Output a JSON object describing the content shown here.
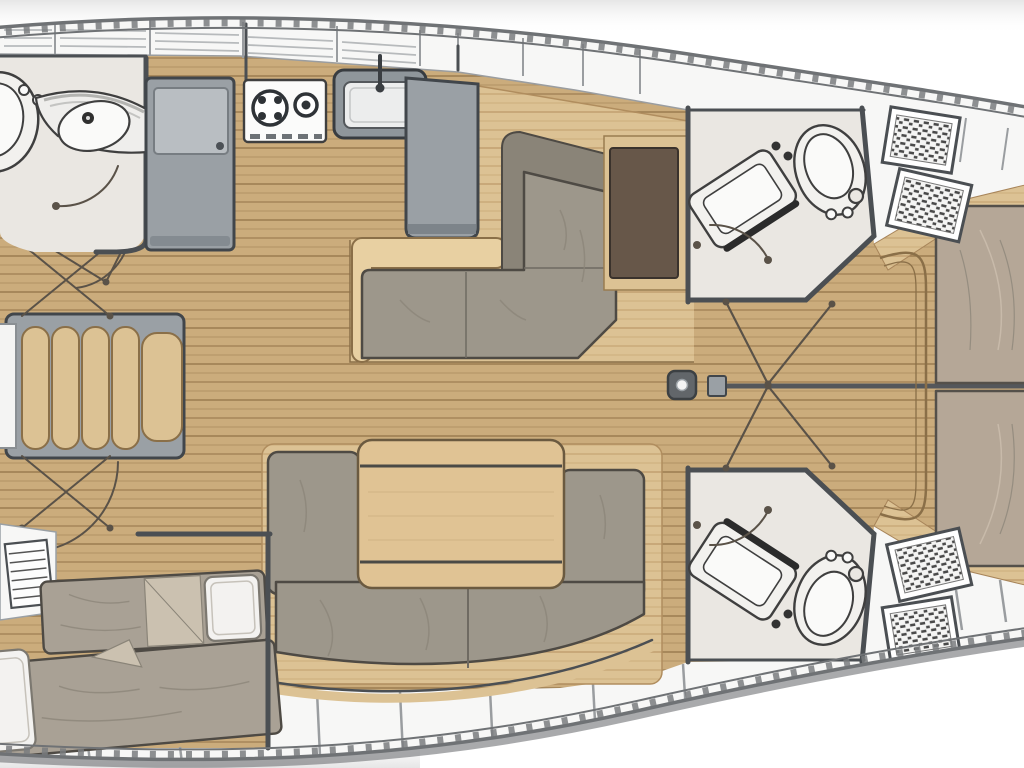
{
  "diagram": {
    "type": "sailing-yacht-interior-floor-plan",
    "view": "top-down",
    "bow_direction": "right",
    "palette": {
      "outside_bg": "#ffffff",
      "corner_shade": "#e6e6e6",
      "hull_line": "#6f7275",
      "rub_rail": "#7a7d7f",
      "deck_white": "#f7f7f6",
      "deck_line": "#9a9da0",
      "louver_line": "#b7babc",
      "floor_wood": "#cbac7c",
      "floor_plank_line": "#9b7c50",
      "platform_wood": "#dcc294",
      "platform_plank_line": "#bb9766",
      "step_wood": "#e8d0a2",
      "step_edge": "#8a6f48",
      "cushion_taupe": "#9d978b",
      "cushion_outline": "#4e4a44",
      "backrest_taupe": "#8a8478",
      "mattress_taupe": "#a9a195",
      "bed_taupe": "#b5a797",
      "pillow_white": "#f3f2f0",
      "table_wood": "#e0c394",
      "table_edge": "#6b5a40",
      "chart_table_brown": "#675749",
      "cabinet_gray": "#9aa0a5",
      "cabinet_outline": "#41464b",
      "cabinet_panel": "#b9bec2",
      "bathroom_floor": "#eae7e2",
      "fixture_white": "#f2f1ee",
      "fixture_outline": "#3f3f3f",
      "wall_dark": "#4b4f53",
      "door_line": "#5a5248",
      "hatch_dark": "#4a4a4a",
      "mast_gray": "#62666a"
    },
    "rooms": [
      {
        "name": "port-head",
        "fixtures": [
          "toilet",
          "curved-vanity-sink",
          "door-swing"
        ]
      },
      {
        "name": "galley",
        "fixtures": [
          "refrigerator",
          "two-burner-stove",
          "sink-with-faucet",
          "island-counter"
        ]
      },
      {
        "name": "dinette",
        "fixtures": [
          "l-shaped-settee",
          "chart-table",
          "raised-platform",
          "step"
        ]
      },
      {
        "name": "salon",
        "fixtures": [
          "u-shaped-sofa",
          "folding-table"
        ]
      },
      {
        "name": "port-aft-cabin",
        "fixtures": [
          "single-berth-with-pillow",
          "single-berth-with-pillow",
          "louvered-step"
        ]
      },
      {
        "name": "lounge-settee",
        "fixtures": [
          "ribbed-chaise",
          "side-shelf"
        ]
      },
      {
        "name": "starboard-head-upper",
        "fixtures": [
          "toilet",
          "angled-vanity-sink",
          "door-swing",
          "companionway-steps"
        ]
      },
      {
        "name": "starboard-head-lower",
        "fixtures": [
          "toilet",
          "angled-vanity-sink",
          "door-swing",
          "companionway-steps"
        ]
      },
      {
        "name": "owner-cabin",
        "fixtures": [
          "island-bed-port-half",
          "island-bed-starboard-half",
          "foot-of-bed-frame"
        ]
      },
      {
        "name": "corridor",
        "fixtures": [
          "mast-post",
          "centerline-partition",
          "double-door-swings"
        ]
      }
    ],
    "hull": {
      "style": "double-line-with-rub-rail-dashes",
      "side_storage": "segmented-lockers-and-louvered-shelves"
    }
  }
}
